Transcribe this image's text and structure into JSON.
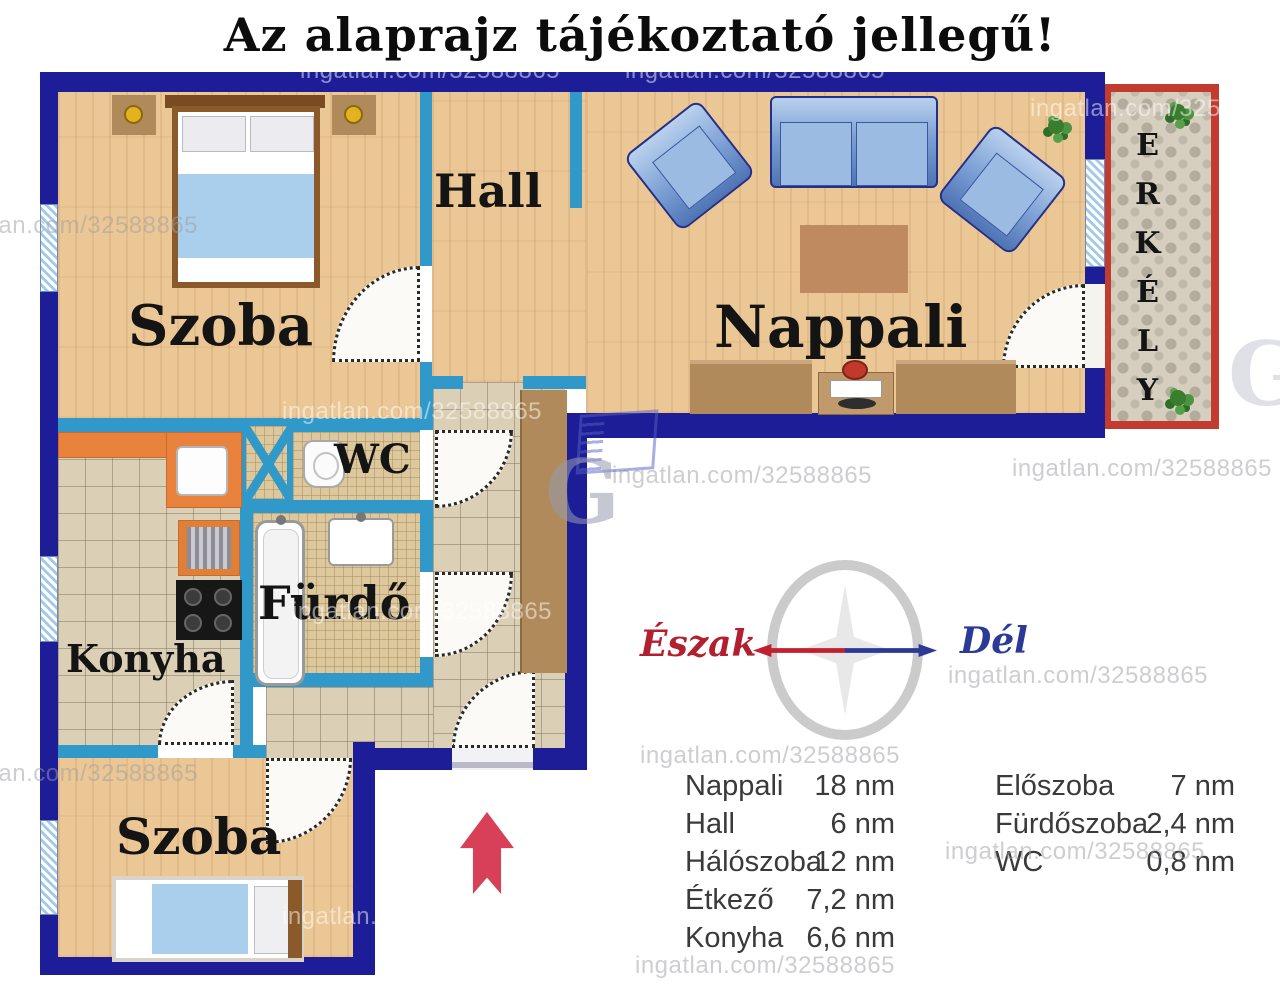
{
  "title": "Az alaprajz tájékoztató jellegű!",
  "watermark": {
    "text": "ingatlan.com/32588865",
    "logo_letter": "G"
  },
  "rooms": {
    "bedroom1": "Szoba",
    "hall": "Hall",
    "living_room": "Nappali",
    "balcony": "ERKÉLY",
    "wc": "WC",
    "bathroom": "Fürdő",
    "kitchen": "Konyha",
    "bedroom2": "Szoba"
  },
  "compass": {
    "north_label": "Észak",
    "south_label": "Dél"
  },
  "legend": {
    "left": [
      {
        "name": "Nappali",
        "area": "18 nm"
      },
      {
        "name": "Hall",
        "area": "6 nm"
      },
      {
        "name": "Hálószoba",
        "area": "12 nm"
      },
      {
        "name": "Étkező",
        "area": "7,2 nm"
      },
      {
        "name": "Konyha",
        "area": "6,6 nm"
      }
    ],
    "right": [
      {
        "name": "Előszoba",
        "area": "7 nm"
      },
      {
        "name": "Fürdőszoba",
        "area": "2,4 nm"
      },
      {
        "name": "WC",
        "area": "0,8 nm"
      }
    ]
  },
  "colors": {
    "outer_wall": "#1d1d97",
    "inner_wall": "#3099c9",
    "balcony_border": "#c23b2e",
    "north": "#b21f2f",
    "south": "#2b3a96",
    "entrance_arrow": "#d84058"
  }
}
